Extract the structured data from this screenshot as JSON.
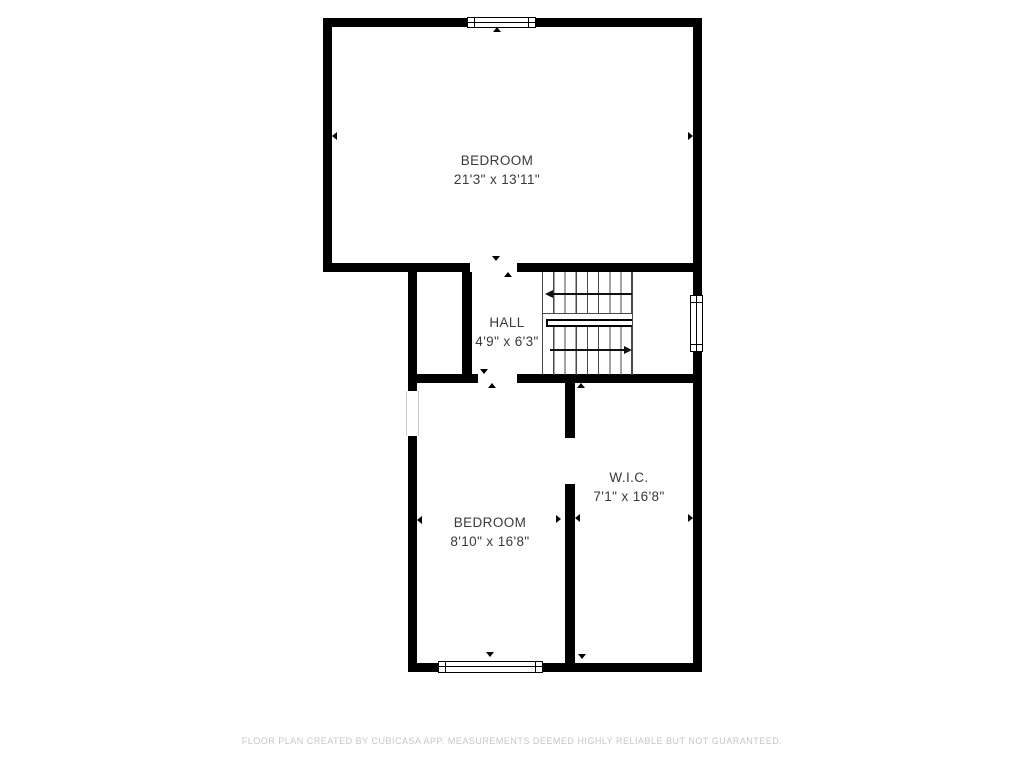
{
  "rooms": [
    {
      "name": "BEDROOM",
      "dimensions": "21'3\" x 13'11\""
    },
    {
      "name": "HALL",
      "dimensions": "4'9\" x 6'3\""
    },
    {
      "name": "BEDROOM",
      "dimensions": "8'10\" x 16'8\""
    },
    {
      "name": "W.I.C.",
      "dimensions": "7'1\" x 16'8\""
    }
  ],
  "footer": {
    "disclaimer": "FLOOR PLAN CREATED BY CUBICASA APP. MEASUREMENTS DEEMED HIGHLY RELIABLE BUT NOT GUARANTEED."
  },
  "colors": {
    "wall": "#000000",
    "room_label": "#3a3a3a",
    "stair_line": "#4a4a4a",
    "footer_text": "#c6c6c6",
    "background": "#ffffff"
  }
}
